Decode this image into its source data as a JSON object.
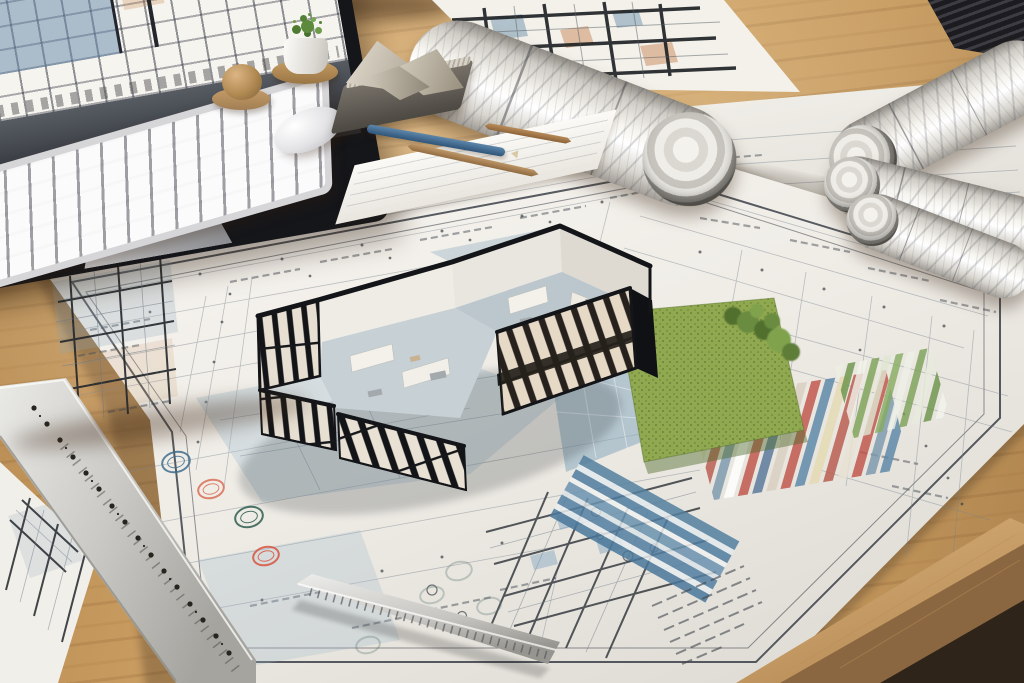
{
  "scene": {
    "type": "photorealistic render",
    "setting": "architect's desk viewed at an angle, covered with blueprints and a 3D cutaway house model",
    "objects": {
      "monitor": {
        "label": "desktop monitor displaying a blueprint drawing"
      },
      "keyboard": {
        "label": "white wireless keyboard"
      },
      "mouse": {
        "label": "white wireless mouse"
      },
      "knob": {
        "label": "bronze desk ornament"
      },
      "plant": {
        "label": "small potted plant on wooden coaster"
      },
      "sculpture": {
        "label": "folded-paper sculpture resting on a dark notepad"
      },
      "pencils": {
        "label": "blue drafting pencil and two wooden styluses on a note sheet"
      },
      "paper_stack": {
        "label": "stack of dark papers in the corner"
      },
      "blueprint_rolls": {
        "label": "rolled blueprint drawings, one partly unrolled"
      },
      "flap_sheet": {
        "label": "unrolled blueprint flap with bold floor plan"
      },
      "under_sheet": {
        "label": "blueprint sheet lying under the rolls"
      },
      "main_blueprint": {
        "label": "large site-plan blueprint sheet with double border"
      },
      "model_house": {
        "label": "black-framed cutaway model of a modern house with glazed walls"
      },
      "lawn": {
        "label": "model lawn patch with miniature trees"
      },
      "terrace": {
        "label": "blue-washed terrace and pool areas around the model"
      },
      "swatch_multicolor": {
        "label": "red, blue and cream striped material band"
      },
      "swatch_green": {
        "label": "green striped material band"
      },
      "swatch_blue": {
        "label": "blue striped material band"
      },
      "stamps": {
        "label": "round colored approval stamp marks"
      },
      "notes_block": {
        "label": "block of small handwritten notes"
      },
      "long_ruler": {
        "label": "perforated metal ruler along the left edge"
      },
      "short_ruler": {
        "label": "metal scale ruler lying on the sheet"
      },
      "side_blueprint": {
        "label": "second blueprint sheet in the lower-left corner"
      },
      "desk": {
        "label": "oak desk surface with front edge at lower right"
      }
    },
    "palette": {
      "wood": "#c89a62",
      "wood_edge_light": "#dcb47e",
      "wood_dark": "#2f241a",
      "paper": "#f4f2ec",
      "line_ink": "#3a4046",
      "model_frame": "#141519",
      "glass_pane": "#e8e1d4",
      "floor_gray_blue": "#bcc7cd",
      "lawn_green": "#90a84f",
      "tree_green": "#51702f",
      "wash_blue": "#a9c2d1",
      "swatch_red": "#c0534a",
      "swatch_blue": "#5b87a8",
      "swatch_cream": "#e4d9b2",
      "swatch_green": "#7aa055",
      "stamp_blue": "#3f6e8e",
      "stamp_red": "#d9543f",
      "stamp_teal": "#2f5d50",
      "metal": "#c9c8c4",
      "screen_blue": "#6084a8",
      "screen_warm": "#c98a54"
    }
  }
}
